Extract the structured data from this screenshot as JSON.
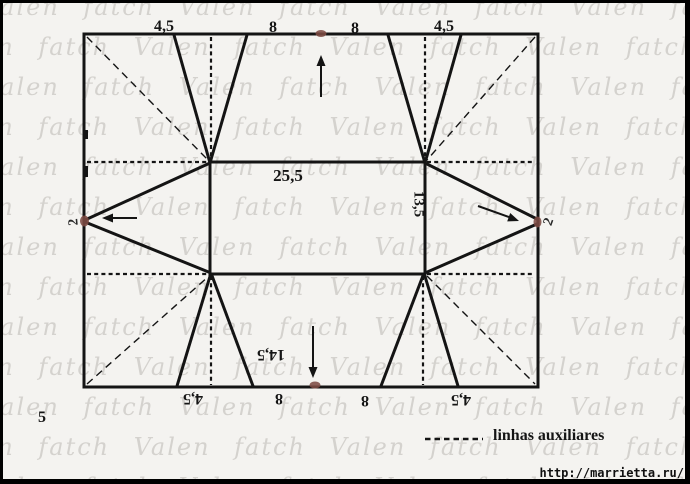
{
  "watermark": {
    "text": "Valen fatch"
  },
  "diagram": {
    "top": {
      "m1": "4,5",
      "m2": "8",
      "m3": "8",
      "m4": "4,5"
    },
    "bottom": {
      "m1": "4,5",
      "m2": "8",
      "m3": "8",
      "m4": "4,5",
      "flap": "14,5"
    },
    "center": {
      "width": "25,5",
      "height": "13,5"
    },
    "left": {
      "seam": "2"
    },
    "right": {
      "seam": "2"
    },
    "step_number": "5"
  },
  "legend": {
    "label": "linhas auxiliares"
  },
  "credit": {
    "url": "http://marrietta.ru/"
  },
  "colors": {
    "line": "#141414",
    "dot": "#7d4b43",
    "watermark": "#c0bdb8"
  }
}
